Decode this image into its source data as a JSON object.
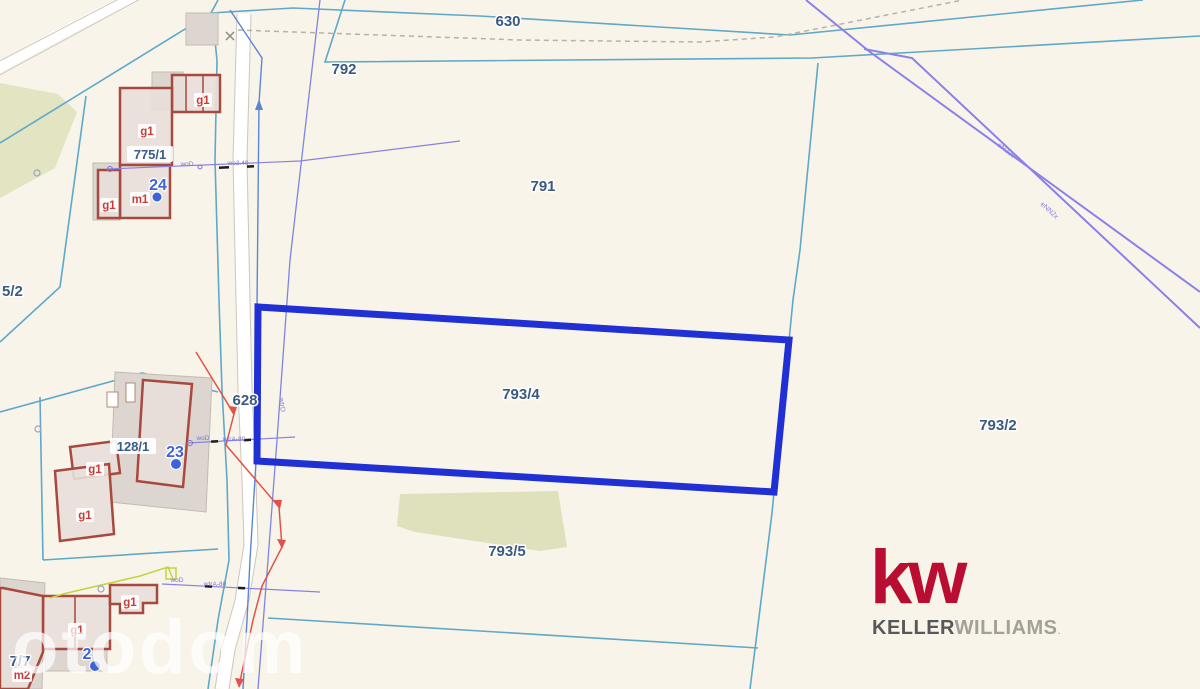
{
  "watermark": "otodom",
  "logo": {
    "mark": "kw",
    "name_bold": "KELLER",
    "name_light": "WILLIAMS",
    "dot": "."
  },
  "parcels": {
    "p630": "630",
    "p792": "792",
    "p791": "791",
    "p775_1": "775/1",
    "p5_2": "5/2",
    "p628": "628",
    "p128_1": "128/1",
    "p793_4": "793/4",
    "p793_2": "793/2",
    "p793_5": "793/5",
    "p7_7": "7/7"
  },
  "buildings": {
    "g1": "g1",
    "m1": "m1",
    "m2": "m2"
  },
  "markers": {
    "m24": "24",
    "m23": "23",
    "m22": "2"
  },
  "utilities": {
    "woD": "woD",
    "wo340": "wo3.40",
    "wtrA80": "wtrA-80",
    "wtrD": "wtrD",
    "eN1": "eN22c",
    "eN2": "eNN2x"
  },
  "colors": {
    "background": "#f8f4ea",
    "highlight_parcel": "#2030d4",
    "boundary_teal": "#5fa8c8",
    "utility_purple": "#8b80e8",
    "building_red": "#a8493e",
    "label_blue": "#3a5980",
    "kw_red": "#b90e31",
    "marker_blue": "#3e63d8",
    "warning_red": "#e15348"
  }
}
